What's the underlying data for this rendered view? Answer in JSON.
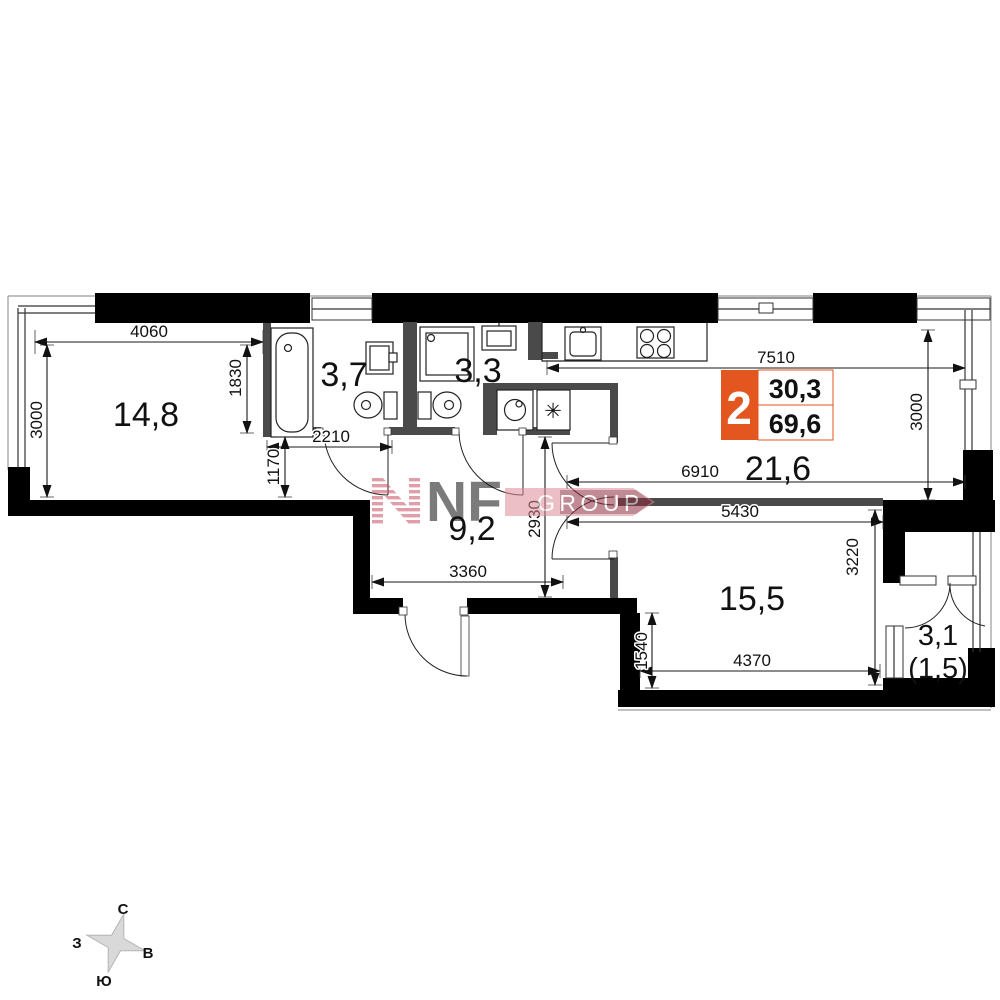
{
  "badge": {
    "rooms_count": "2",
    "living_area": "30,3",
    "total_area": "69,6",
    "accent_color": "#e4561f"
  },
  "rooms": {
    "living": "14,8",
    "bathroom_large": "3,7",
    "bathroom_small": "3,3",
    "kitchen_living": "21,6",
    "hall": "9,2",
    "bedroom": "15,5",
    "balcony": "3,1",
    "balcony_reduced": "(1,5)"
  },
  "dimensions": {
    "living_width": "4060",
    "living_height": "3000",
    "bath_depth": "1830",
    "bath_width": "2210",
    "niche_height": "1170",
    "kitchen_width_full": "7510",
    "kitchen_height": "3000",
    "kitchen_width_inner": "6910",
    "hall_height": "2930",
    "hall_width": "3360",
    "bedroom_width_top": "5430",
    "bedroom_height": "3220",
    "bedroom_step": "1540",
    "bedroom_width_bottom": "4370"
  },
  "compass": {
    "north": "С",
    "east": "В",
    "south": "Ю",
    "west": "З"
  },
  "watermark": {
    "logo_text": "NF",
    "group_text": "GROUP"
  },
  "appliance_symbol": "✳"
}
